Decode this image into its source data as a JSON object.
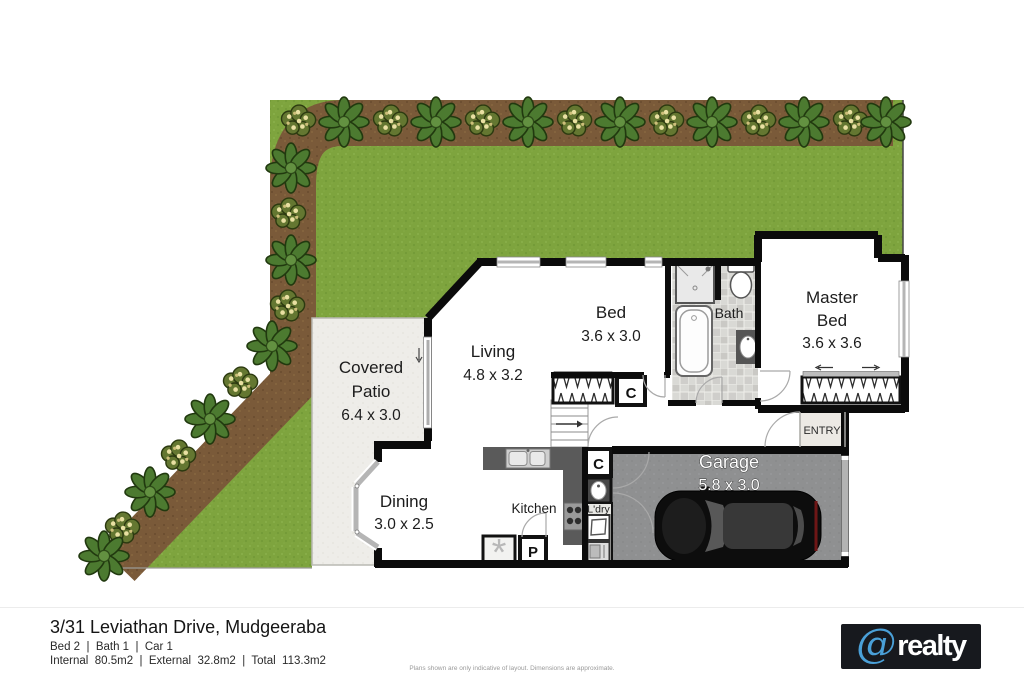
{
  "plan": {
    "rooms": {
      "patio": {
        "line1": "Covered",
        "line2": "Patio",
        "dims": "6.4 x 3.0"
      },
      "living": {
        "name": "Living",
        "dims": "4.8 x 3.2"
      },
      "dining": {
        "name": "Dining",
        "dims": "3.0 x 2.5"
      },
      "kitchen": {
        "name": "Kitchen"
      },
      "bed": {
        "name": "Bed",
        "dims": "3.6 x 3.0"
      },
      "bath": {
        "name": "Bath"
      },
      "master": {
        "line1": "Master",
        "line2": "Bed",
        "dims": "3.6 x 3.6"
      },
      "garage": {
        "name": "Garage",
        "dims": "5.8 x 3.0"
      },
      "entry": {
        "name": "ENTRY"
      },
      "laundry": {
        "name": "L'dry"
      }
    },
    "markers": {
      "closet": "C",
      "pantry": "P",
      "hws": "*"
    }
  },
  "footer": {
    "address": "3/31 Leviathan Drive, Mudgeeraba",
    "summary": "Bed 2  |  Bath 1  |  Car 1",
    "areas": "Internal  80.5m2  |  External  32.8m2  |  Total  113.3m2",
    "disclaimer": "Plans shown are only indicative of layout. Dimensions are approximate."
  },
  "logo": {
    "symbol": "@",
    "text": "realty"
  },
  "colors": {
    "lawn": "#7ea43e",
    "garden_bed": "#7a5a39",
    "patio": "#eeede9",
    "garage_floor": "#8f9091",
    "wall": "#0b0b0b",
    "logo_bg": "#17191e",
    "logo_accent": "#4aa0d8"
  }
}
